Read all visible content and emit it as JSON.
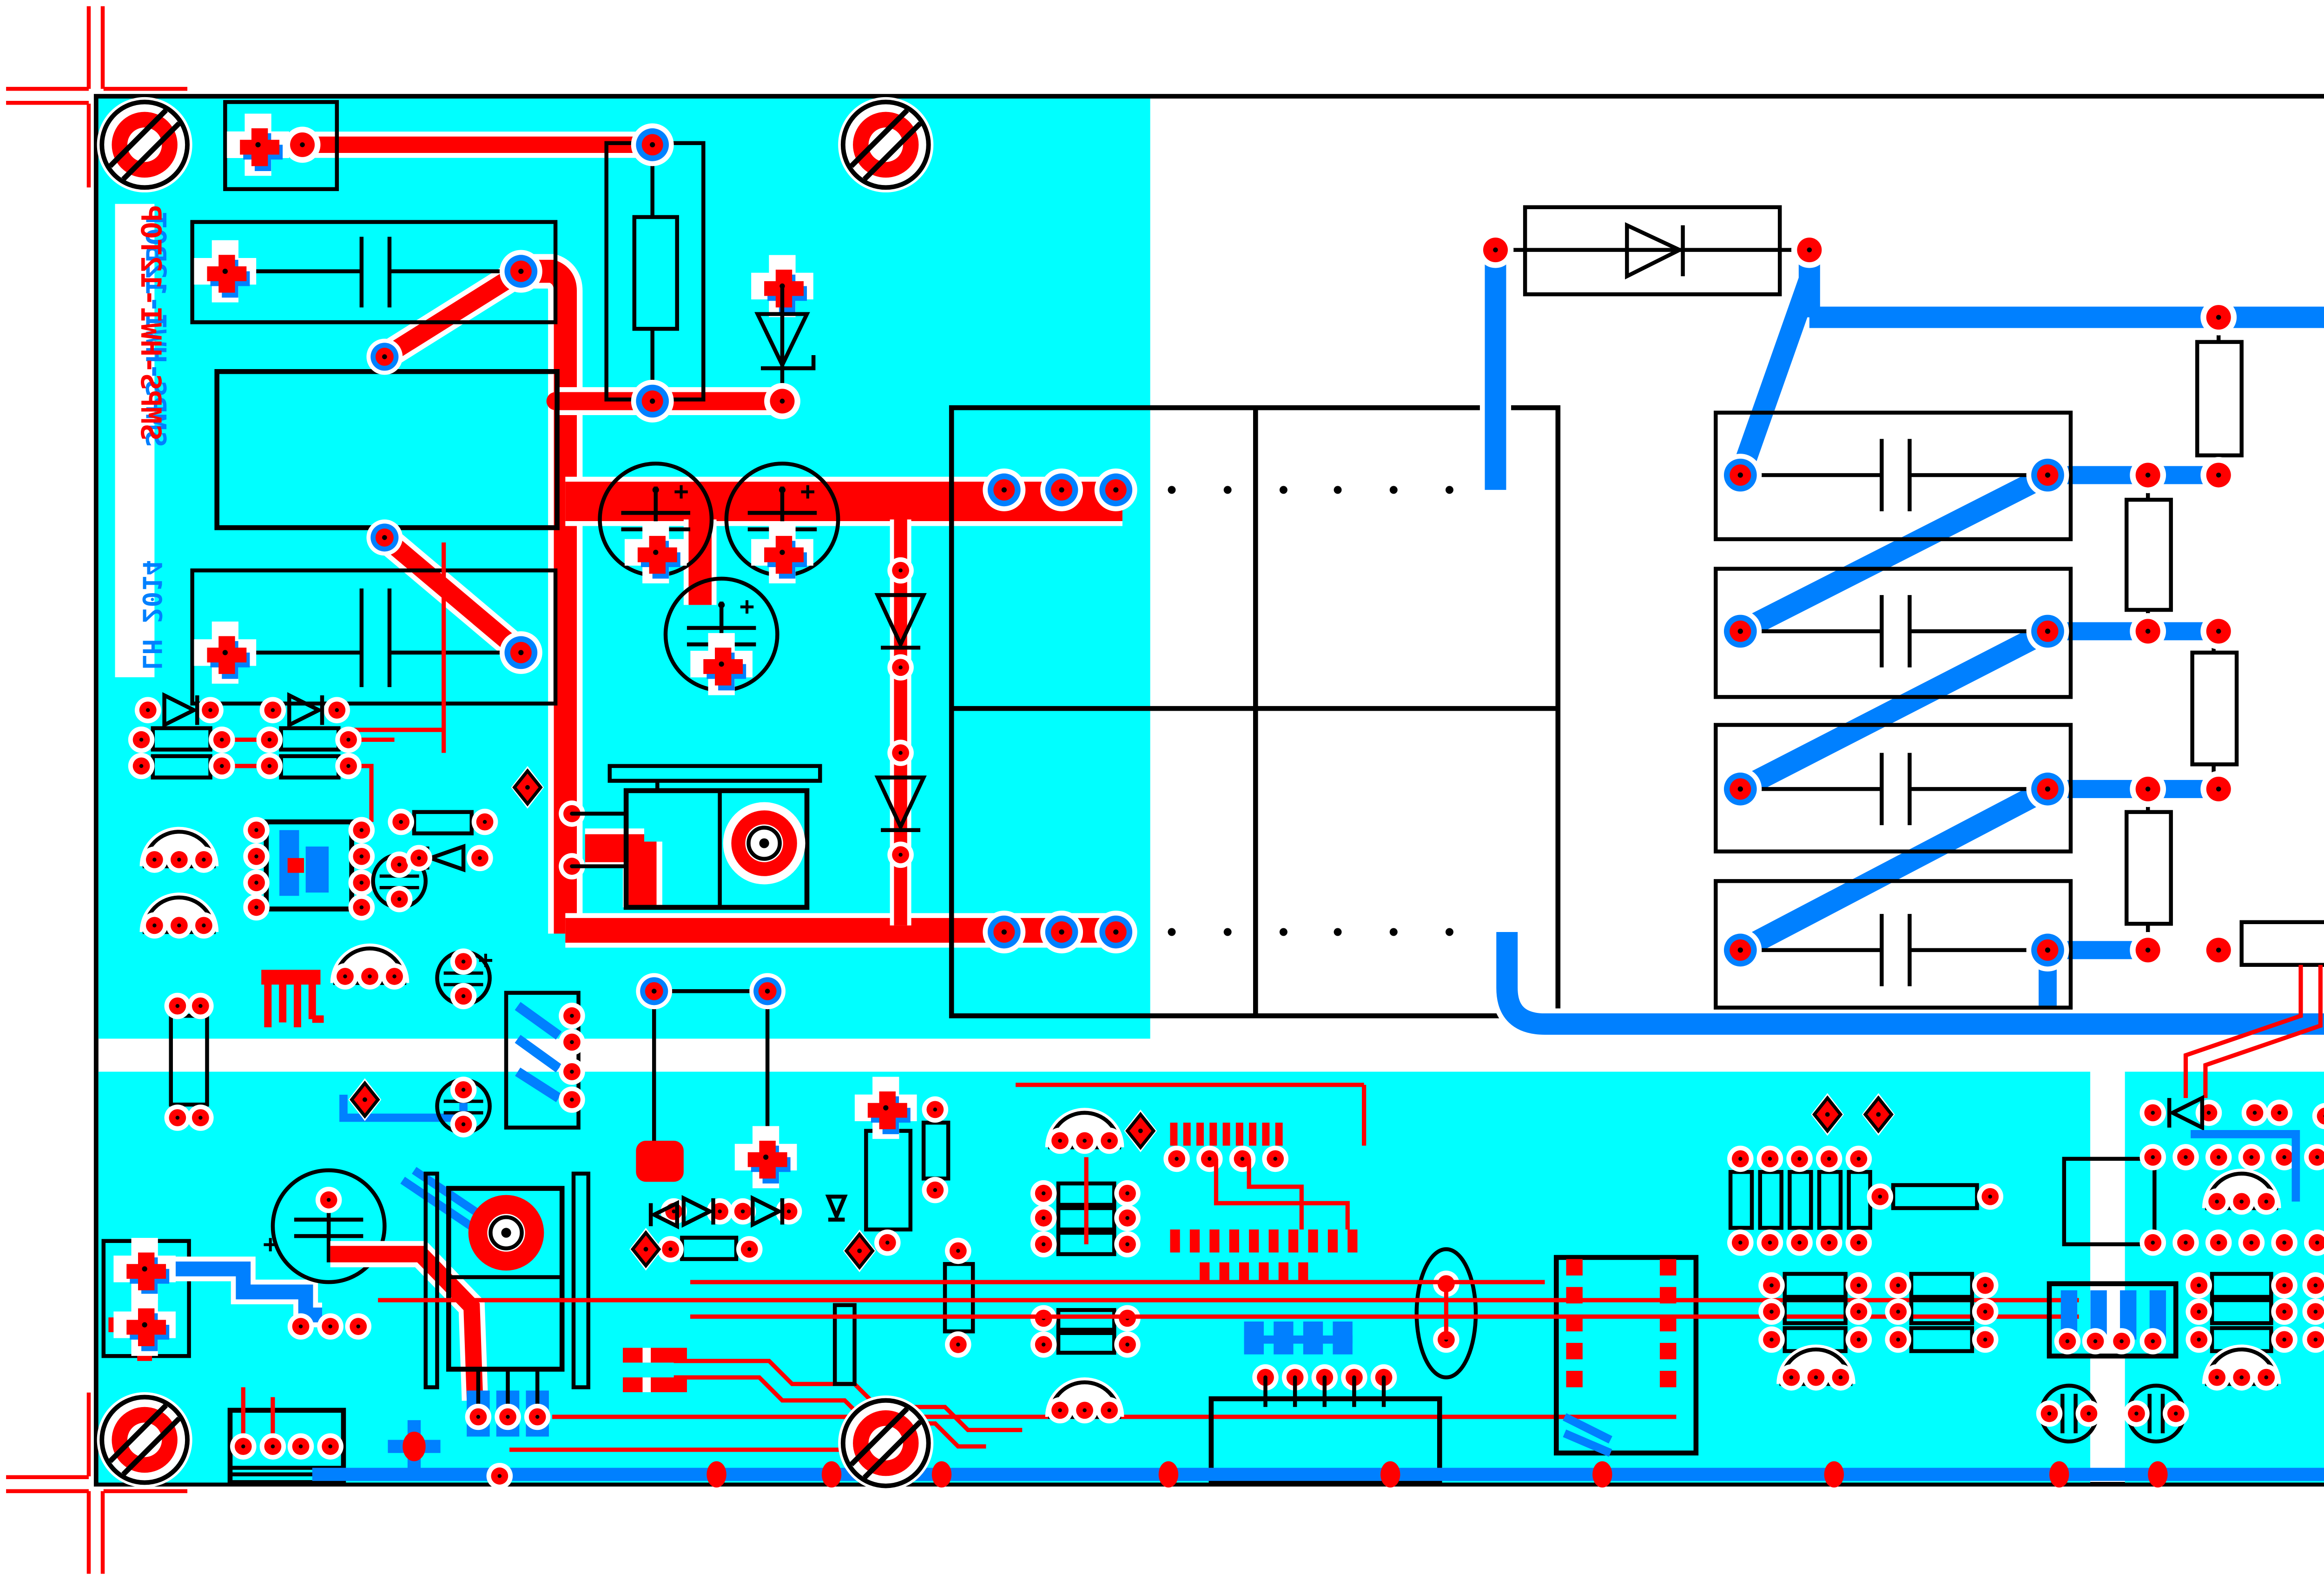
{
  "board": {
    "title_top_layer": "SMPS-HWI-12TOP",
    "title_bottom_layer": "SMPS-HWI-12BOT",
    "author_year": "LH 2014",
    "plus": "+"
  },
  "colors": {
    "red": "#FF0000",
    "blue": "#0080FF",
    "cyan": "#00FFFF",
    "silk": "#000000",
    "bg": "#FFFFFF"
  },
  "legend": {
    "red_layer": "top copper (mirrored text: SMPS-HWI-12TOP)",
    "blue_layer": "bottom copper (mirrored text: SMPS-HWI-12BOT)",
    "cyan_area": "board / copper pour region",
    "black_lines": "silkscreen outlines and board edge",
    "mount_hole_count": 6,
    "registration_marks": 4
  }
}
